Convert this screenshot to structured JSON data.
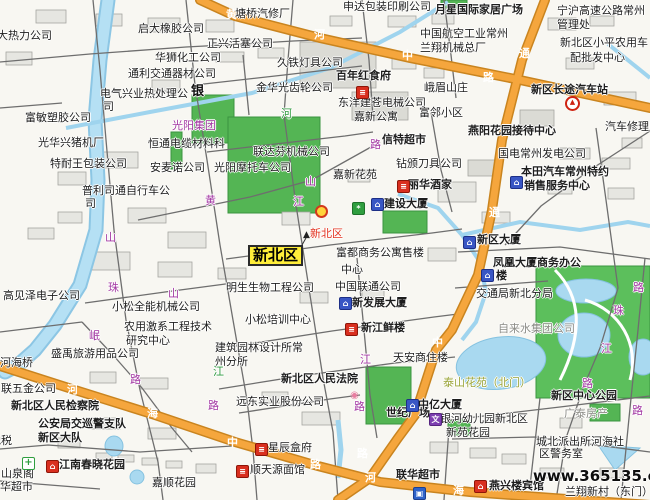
{
  "map": {
    "site": "www.365135.com",
    "region_highlight": "新北区",
    "colors": {
      "major_road": "#f5a63d",
      "major_road_border": "#c9841f",
      "water": "#a9d9f0",
      "green_area": "#54b554",
      "minor_road": "#6e6e6e",
      "highlight_box": "#ffee3a",
      "road_label_purple": "#a236a2",
      "poi_red": "#e2321f"
    },
    "labels": [
      {
        "t": "大热力公司",
        "x": -3,
        "y": 30,
        "c": "p"
      },
      {
        "t": "启大橡胶公司",
        "x": 138,
        "y": 23,
        "c": "p"
      },
      {
        "t": "申达包装印刷公司",
        "x": 343,
        "y": 1,
        "c": "p"
      },
      {
        "t": "塘桥汽修厂",
        "x": 235,
        "y": 8,
        "c": "p"
      },
      {
        "t": "正兴活塞公司",
        "x": 207,
        "y": 38,
        "c": "p"
      },
      {
        "t": "华狮化工公司",
        "x": 155,
        "y": 52,
        "c": "p"
      },
      {
        "t": "通利交通器材公司",
        "x": 128,
        "y": 68,
        "c": "p"
      },
      {
        "t": "久铁灯具公司",
        "x": 277,
        "y": 57,
        "c": "p"
      },
      {
        "t": "金华光齿轮公司",
        "x": 256,
        "y": 82,
        "c": "p"
      },
      {
        "t": "东洋建苍电械公司",
        "x": 338,
        "y": 97,
        "c": "p"
      },
      {
        "t": "嘉新公寓",
        "x": 354,
        "y": 111,
        "c": "p"
      },
      {
        "t": "中国航空工业常州",
        "x": 420,
        "y": 28,
        "c": "p"
      },
      {
        "t": "兰翔机械总厂",
        "x": 420,
        "y": 42,
        "c": "p"
      },
      {
        "t": "宁沪高速公路常州",
        "x": 557,
        "y": 5,
        "c": "p"
      },
      {
        "t": "管理处",
        "x": 557,
        "y": 19,
        "c": "p"
      },
      {
        "t": "新北区小平农用车",
        "x": 560,
        "y": 37,
        "c": "p"
      },
      {
        "t": "配批发中心",
        "x": 570,
        "y": 52,
        "c": "p"
      },
      {
        "t": "电气兴业热处理公",
        "x": 100,
        "y": 88,
        "c": "p"
      },
      {
        "t": "司",
        "x": 103,
        "y": 101,
        "c": "p"
      },
      {
        "t": "银",
        "x": 191,
        "y": 86,
        "c": "bl"
      },
      {
        "t": "恒通电缆材料科",
        "x": 148,
        "y": 138,
        "c": "p"
      },
      {
        "t": "安麦诺公司",
        "x": 150,
        "y": 162,
        "c": "p"
      },
      {
        "t": "光阳摩托车公司",
        "x": 214,
        "y": 162,
        "c": "p"
      },
      {
        "t": "光阳集团",
        "x": 172,
        "y": 120,
        "c": "rp"
      },
      {
        "t": "联达芬机械公司",
        "x": 253,
        "y": 146,
        "c": "p"
      },
      {
        "t": "嘉新花苑",
        "x": 333,
        "y": 169,
        "c": "p"
      },
      {
        "t": "钻颁刀具公司",
        "x": 396,
        "y": 158,
        "c": "p"
      },
      {
        "t": "峨眉山庄",
        "x": 424,
        "y": 82,
        "c": "p"
      },
      {
        "t": "富邻小区",
        "x": 419,
        "y": 107,
        "c": "p"
      },
      {
        "t": "汽车修理厂",
        "x": 605,
        "y": 121,
        "c": "p"
      },
      {
        "t": "富敏塑胶公司",
        "x": 25,
        "y": 112,
        "c": "p"
      },
      {
        "t": "光华兴猪机厂",
        "x": 38,
        "y": 137,
        "c": "p"
      },
      {
        "t": "特耐王包装公司",
        "x": 50,
        "y": 158,
        "c": "p"
      },
      {
        "t": "普利司通自行车公",
        "x": 82,
        "y": 185,
        "c": "p"
      },
      {
        "t": "司",
        "x": 85,
        "y": 198,
        "c": "p"
      },
      {
        "t": "高见泽电子公司",
        "x": 3,
        "y": 290,
        "c": "p"
      },
      {
        "t": "小松全能机械公司",
        "x": 112,
        "y": 301,
        "c": "p"
      },
      {
        "t": "农用激系工程技术",
        "x": 124,
        "y": 321,
        "c": "p"
      },
      {
        "t": "研究中心",
        "x": 126,
        "y": 335,
        "c": "p"
      },
      {
        "t": "盛禹旅游用品公司",
        "x": 51,
        "y": 348,
        "c": "p"
      },
      {
        "t": "河海桥",
        "x": 0,
        "y": 357,
        "c": "p"
      },
      {
        "t": "联五金公司",
        "x": 1,
        "y": 383,
        "c": "p"
      },
      {
        "t": "明生生物工程公司",
        "x": 226,
        "y": 282,
        "c": "p"
      },
      {
        "t": "中国联通公司",
        "x": 335,
        "y": 281,
        "c": "p"
      },
      {
        "t": "小松培训中心",
        "x": 245,
        "y": 314,
        "c": "p"
      },
      {
        "t": "建筑园林设计所常",
        "x": 215,
        "y": 342,
        "c": "p"
      },
      {
        "t": "州分所",
        "x": 215,
        "y": 356,
        "c": "p"
      },
      {
        "t": "天安商住楼",
        "x": 393,
        "y": 352,
        "c": "p"
      },
      {
        "t": "远东实业股份公司",
        "x": 236,
        "y": 396,
        "c": "p"
      },
      {
        "t": "交通局新北分局",
        "x": 476,
        "y": 288,
        "c": "p"
      },
      {
        "t": "自来水集团公司",
        "x": 498,
        "y": 323,
        "c": "g"
      },
      {
        "t": "城北派出所河海社",
        "x": 536,
        "y": 436,
        "c": "p"
      },
      {
        "t": "区警务室",
        "x": 539,
        "y": 448,
        "c": "p"
      },
      {
        "t": "嘉顺花园",
        "x": 152,
        "y": 477,
        "c": "p"
      },
      {
        "t": "山泉阁",
        "x": 1,
        "y": 468,
        "c": "p"
      },
      {
        "t": "华超市",
        "x": 0,
        "y": 481,
        "c": "p"
      },
      {
        "t": "地税",
        "x": -10,
        "y": 435,
        "c": "p"
      },
      {
        "t": "星辰盒府",
        "x": 268,
        "y": 442,
        "c": "p"
      },
      {
        "t": "顺天源面馆",
        "x": 250,
        "y": 464,
        "c": "p"
      },
      {
        "t": "兰翔新村（东门）",
        "x": 565,
        "y": 486,
        "c": "p"
      },
      {
        "t": "银河幼儿园新北区",
        "x": 440,
        "y": 413,
        "c": "p"
      },
      {
        "t": "新苑花园",
        "x": 446,
        "y": 427,
        "c": "p"
      },
      {
        "t": "广泰房产",
        "x": 564,
        "y": 408,
        "c": "g"
      },
      {
        "t": "富都商务公寓售楼",
        "x": 336,
        "y": 247,
        "c": "p"
      },
      {
        "t": "中心",
        "x": 341,
        "y": 264,
        "c": "p"
      },
      {
        "t": "凤凰大厦商务办公",
        "x": 493,
        "y": 257,
        "c": "b"
      },
      {
        "t": "楼",
        "x": 496,
        "y": 270,
        "c": "b"
      },
      {
        "t": "国电常州发电公司",
        "x": 498,
        "y": 148,
        "c": "p"
      },
      {
        "t": "月星国际家居广场",
        "x": 435,
        "y": 4,
        "c": "b"
      },
      {
        "t": "百年红食府",
        "x": 336,
        "y": 70,
        "c": "b"
      },
      {
        "t": "新区长途汽车站",
        "x": 531,
        "y": 84,
        "c": "b"
      },
      {
        "t": "信特超市",
        "x": 382,
        "y": 134,
        "c": "b"
      },
      {
        "t": "燕阳花园接待中心",
        "x": 468,
        "y": 125,
        "c": "b"
      },
      {
        "t": "本田汽车常州特约",
        "x": 521,
        "y": 166,
        "c": "b"
      },
      {
        "t": "销售服务中心",
        "x": 524,
        "y": 180,
        "c": "b"
      },
      {
        "t": "丽华酒家",
        "x": 408,
        "y": 179,
        "c": "b"
      },
      {
        "t": "建设大厦",
        "x": 384,
        "y": 198,
        "c": "b"
      },
      {
        "t": "新区大厦",
        "x": 477,
        "y": 234,
        "c": "b"
      },
      {
        "t": "新发展大厦",
        "x": 352,
        "y": 297,
        "c": "b"
      },
      {
        "t": "新江鲜楼",
        "x": 361,
        "y": 322,
        "c": "b"
      },
      {
        "t": "新北区人民法院",
        "x": 281,
        "y": 373,
        "c": "b"
      },
      {
        "t": "新北区人民检察院",
        "x": 11,
        "y": 400,
        "c": "b"
      },
      {
        "t": "公安局交巡警支队",
        "x": 38,
        "y": 418,
        "c": "b"
      },
      {
        "t": "新区大队",
        "x": 38,
        "y": 432,
        "c": "b"
      },
      {
        "t": "世纪广场",
        "x": 386,
        "y": 407,
        "c": "b"
      },
      {
        "t": "中亿大厦",
        "x": 418,
        "y": 399,
        "c": "b"
      },
      {
        "t": "新区中心公园",
        "x": 551,
        "y": 390,
        "c": "b"
      },
      {
        "t": "江南春晓花园",
        "x": 59,
        "y": 459,
        "c": "b"
      },
      {
        "t": "联华超市",
        "x": 396,
        "y": 469,
        "c": "b"
      },
      {
        "t": "燕兴楼宾馆",
        "x": 489,
        "y": 480,
        "c": "b"
      },
      {
        "t": "泰山花苑（北门）",
        "x": 443,
        "y": 377,
        "c": "o"
      },
      {
        "t": "新北区",
        "x": 310,
        "y": 228,
        "c": "r",
        "n": "district-poi-label"
      },
      {
        "t": "新北区",
        "x": 248,
        "y": 245,
        "c": "lm",
        "n": "region-highlight"
      },
      {
        "t": "www.365135.com",
        "x": 533,
        "y": 470,
        "c": "w",
        "n": "watermark"
      },
      {
        "t": "黄",
        "x": 226,
        "y": 9,
        "c": "ro"
      },
      {
        "t": "河",
        "x": 314,
        "y": 29,
        "c": "ro"
      },
      {
        "t": "中",
        "x": 402,
        "y": 50,
        "c": "ro"
      },
      {
        "t": "通",
        "x": 519,
        "y": 48,
        "c": "ro"
      },
      {
        "t": "路",
        "x": 483,
        "y": 72,
        "c": "ro"
      },
      {
        "t": "通",
        "x": 489,
        "y": 207,
        "c": "ro"
      },
      {
        "t": "中",
        "x": 432,
        "y": 337,
        "c": "ro"
      },
      {
        "t": "河",
        "x": 67,
        "y": 384,
        "c": "ro"
      },
      {
        "t": "海",
        "x": 147,
        "y": 408,
        "c": "ro"
      },
      {
        "t": "中",
        "x": 227,
        "y": 437,
        "c": "ro"
      },
      {
        "t": "路",
        "x": 310,
        "y": 459,
        "c": "ro"
      },
      {
        "t": "路",
        "x": 357,
        "y": 448,
        "c": "ro"
      },
      {
        "t": "河",
        "x": 365,
        "y": 472,
        "c": "ro"
      },
      {
        "t": "海",
        "x": 453,
        "y": 485,
        "c": "ro"
      },
      {
        "t": "黄",
        "x": 205,
        "y": 195,
        "c": "rp"
      },
      {
        "t": "山",
        "x": 305,
        "y": 176,
        "c": "rp"
      },
      {
        "t": "江",
        "x": 293,
        "y": 196,
        "c": "rp"
      },
      {
        "t": "山",
        "x": 105,
        "y": 232,
        "c": "rp"
      },
      {
        "t": "珠",
        "x": 108,
        "y": 282,
        "c": "rp"
      },
      {
        "t": "山",
        "x": 168,
        "y": 288,
        "c": "rp"
      },
      {
        "t": "岷",
        "x": 89,
        "y": 330,
        "c": "rp"
      },
      {
        "t": "路",
        "x": 130,
        "y": 374,
        "c": "rp"
      },
      {
        "t": "路",
        "x": 208,
        "y": 400,
        "c": "rp"
      },
      {
        "t": "江",
        "x": 360,
        "y": 354,
        "c": "rp"
      },
      {
        "t": "路",
        "x": 354,
        "y": 401,
        "c": "rp"
      },
      {
        "t": "路",
        "x": 370,
        "y": 139,
        "c": "rp"
      },
      {
        "t": "珠",
        "x": 613,
        "y": 305,
        "c": "rp"
      },
      {
        "t": "江",
        "x": 601,
        "y": 343,
        "c": "rp"
      },
      {
        "t": "路",
        "x": 582,
        "y": 378,
        "c": "rp"
      },
      {
        "t": "路",
        "x": 633,
        "y": 282,
        "c": "rp"
      },
      {
        "t": "路",
        "x": 632,
        "y": 405,
        "c": "rp"
      },
      {
        "t": "河",
        "x": 281,
        "y": 108,
        "c": "rv"
      },
      {
        "t": "江",
        "x": 213,
        "y": 366,
        "c": "rv"
      }
    ],
    "icons": [
      {
        "n": "restaurant-icon",
        "x": 397,
        "y": 180,
        "s": "ic-redrest",
        "g": "≡"
      },
      {
        "n": "restaurant-icon",
        "x": 345,
        "y": 323,
        "s": "ic-redrest",
        "g": "≡"
      },
      {
        "n": "restaurant-icon",
        "x": 255,
        "y": 443,
        "s": "ic-redrest",
        "g": "≡"
      },
      {
        "n": "restaurant-icon",
        "x": 236,
        "y": 465,
        "s": "ic-redrest",
        "g": "≡"
      },
      {
        "n": "restaurant-icon",
        "x": 356,
        "y": 86,
        "s": "ic-redrest",
        "g": "≡"
      },
      {
        "n": "hotel-icon",
        "x": 46,
        "y": 460,
        "s": "ic-redrest",
        "g": "⌂"
      },
      {
        "n": "hotel-icon",
        "x": 474,
        "y": 480,
        "s": "ic-redrest",
        "g": "⌂"
      },
      {
        "n": "building-icon",
        "x": 371,
        "y": 198,
        "s": "ic-bluebldg",
        "g": "⌂"
      },
      {
        "n": "building-icon",
        "x": 339,
        "y": 297,
        "s": "ic-bluebldg",
        "g": "⌂"
      },
      {
        "n": "building-icon",
        "x": 463,
        "y": 236,
        "s": "ic-bluebldg",
        "g": "⌂"
      },
      {
        "n": "building-icon",
        "x": 406,
        "y": 399,
        "s": "ic-bluebldg",
        "g": "⌂"
      },
      {
        "n": "building-icon",
        "x": 481,
        "y": 269,
        "s": "ic-bluebldg",
        "g": "⌂"
      },
      {
        "n": "building-icon",
        "x": 510,
        "y": 176,
        "s": "ic-bluebldg",
        "g": "⌂"
      },
      {
        "n": "shop-icon",
        "x": 413,
        "y": 487,
        "s": "ic-bag",
        "g": "▣"
      },
      {
        "n": "bus-station-icon",
        "x": 565,
        "y": 96,
        "s": "ic-bus",
        "g": "▲"
      },
      {
        "n": "route-badge-icon",
        "x": 315,
        "y": 205,
        "s": "ic-route",
        "g": ""
      },
      {
        "n": "park-badge-icon",
        "x": 352,
        "y": 202,
        "s": "ic-green",
        "g": "*"
      },
      {
        "n": "monument-icon",
        "x": 301,
        "y": 230,
        "s": "ic-mon",
        "g": "▲"
      },
      {
        "n": "flower-icon",
        "x": 349,
        "y": 390,
        "s": "ic-flower",
        "g": "◉"
      },
      {
        "n": "school-icon",
        "x": 429,
        "y": 413,
        "s": "ic-wen",
        "g": "文"
      },
      {
        "n": "pharmacy-icon",
        "x": 22,
        "y": 457,
        "s": "ic-cross",
        "g": "+"
      }
    ]
  }
}
